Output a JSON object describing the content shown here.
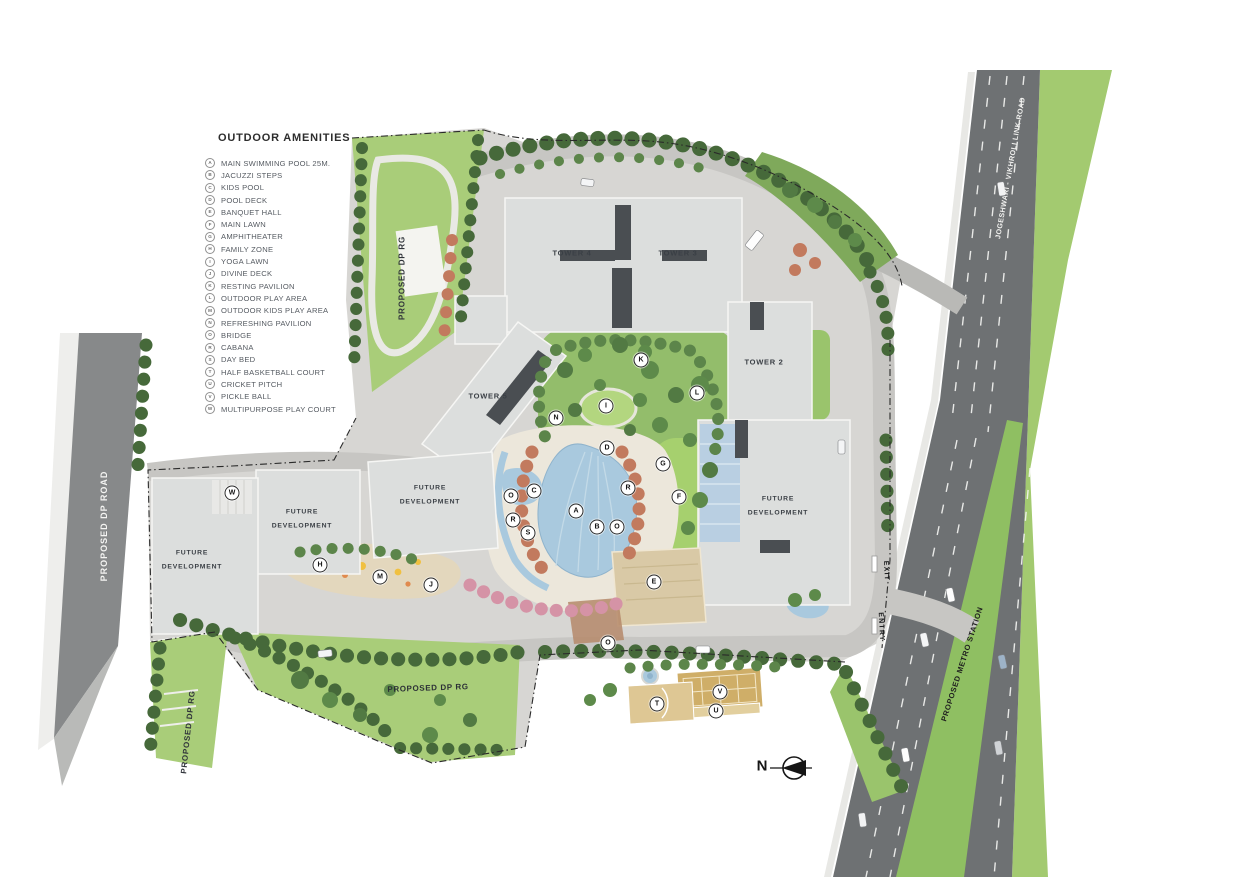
{
  "legend": {
    "title": "OUTDOOR AMENITIES",
    "items": [
      {
        "key": "A",
        "label": "MAIN SWIMMING POOL 25M."
      },
      {
        "key": "B",
        "label": "JACUZZI STEPS"
      },
      {
        "key": "C",
        "label": "KIDS POOL"
      },
      {
        "key": "D",
        "label": "POOL DECK"
      },
      {
        "key": "E",
        "label": "BANQUET HALL"
      },
      {
        "key": "F",
        "label": "MAIN LAWN"
      },
      {
        "key": "G",
        "label": "AMPHITHEATER"
      },
      {
        "key": "H",
        "label": "FAMILY ZONE"
      },
      {
        "key": "I",
        "label": "YOGA LAWN"
      },
      {
        "key": "J",
        "label": "DIVINE DECK"
      },
      {
        "key": "K",
        "label": "RESTING PAVILION"
      },
      {
        "key": "L",
        "label": "OUTDOOR PLAY AREA"
      },
      {
        "key": "M",
        "label": "OUTDOOR KIDS PLAY AREA"
      },
      {
        "key": "N",
        "label": "REFRESHING PAVILION"
      },
      {
        "key": "O",
        "label": "BRIDGE"
      },
      {
        "key": "R",
        "label": "CABANA"
      },
      {
        "key": "S",
        "label": "DAY BED"
      },
      {
        "key": "T",
        "label": "HALF BASKETBALL COURT"
      },
      {
        "key": "U",
        "label": "CRICKET PITCH"
      },
      {
        "key": "V",
        "label": "PICKLE BALL"
      },
      {
        "key": "W",
        "label": "MULTIPURPOSE PLAY COURT"
      }
    ]
  },
  "map": {
    "towers": {
      "tower2": "TOWER 2",
      "tower3": "TOWER 3",
      "tower4": "TOWER 4",
      "tower5": "TOWER 5"
    },
    "future_development": "FUTURE DEVELOPMENT",
    "roads": {
      "proposed_dp_road": "PROPOSED DP ROAD",
      "jvlr": "JOGESHWARI - VIKHROLI LINK ROAD",
      "metro": "PROPOSED METRO STATION",
      "dp_rg": "PROPOSED DP RG",
      "entry": "ENTRY",
      "exit": "EXIT"
    },
    "compass_north": "N",
    "markers": [
      {
        "key": "A",
        "x": 576,
        "y": 511
      },
      {
        "key": "B",
        "x": 597,
        "y": 527
      },
      {
        "key": "C",
        "x": 534,
        "y": 491
      },
      {
        "key": "D",
        "x": 607,
        "y": 448
      },
      {
        "key": "E",
        "x": 654,
        "y": 582
      },
      {
        "key": "F",
        "x": 679,
        "y": 497
      },
      {
        "key": "G",
        "x": 663,
        "y": 464
      },
      {
        "key": "H",
        "x": 320,
        "y": 565
      },
      {
        "key": "I",
        "x": 606,
        "y": 406
      },
      {
        "key": "J",
        "x": 431,
        "y": 585
      },
      {
        "key": "K",
        "x": 641,
        "y": 360
      },
      {
        "key": "L",
        "x": 697,
        "y": 393
      },
      {
        "key": "M",
        "x": 380,
        "y": 577
      },
      {
        "key": "N",
        "x": 556,
        "y": 418
      },
      {
        "key": "O",
        "x": 511,
        "y": 496
      },
      {
        "key": "O",
        "x": 617,
        "y": 527
      },
      {
        "key": "O",
        "x": 608,
        "y": 643
      },
      {
        "key": "R",
        "x": 628,
        "y": 488
      },
      {
        "key": "R",
        "x": 513,
        "y": 520
      },
      {
        "key": "S",
        "x": 528,
        "y": 533
      },
      {
        "key": "T",
        "x": 657,
        "y": 704
      },
      {
        "key": "U",
        "x": 716,
        "y": 711
      },
      {
        "key": "V",
        "x": 720,
        "y": 692
      },
      {
        "key": "W",
        "x": 232,
        "y": 493
      }
    ]
  },
  "colors": {
    "lawn": "#9cc467",
    "tree_dark": "#46693a",
    "tree_mid": "#5c854a",
    "flower": "#c27a5e",
    "pink": "#d593a6",
    "pool": "#a9c9de",
    "road_dark": "#6e7173",
    "paver": "#c9c8c5",
    "building": "#dcdedd",
    "court_tan": "#cfae68"
  }
}
